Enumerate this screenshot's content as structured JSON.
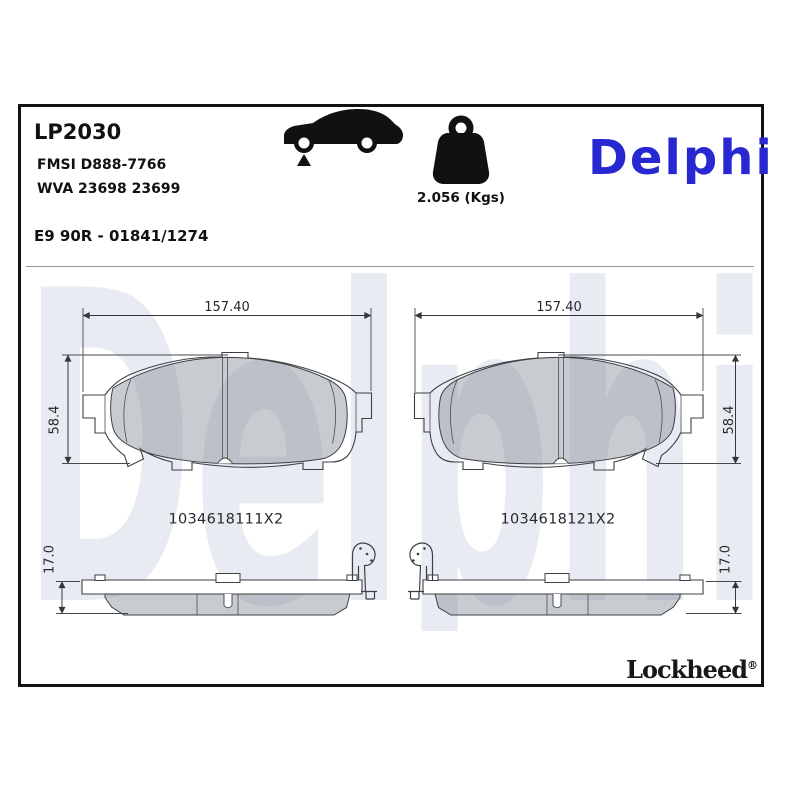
{
  "header": {
    "product_code": "LP2030",
    "fmsi": "FMSI D888-7766",
    "wva": "WVA 23698 23699",
    "homologation": "E9 90R - 01841/1274",
    "weight_label": "2.056 (Kgs)",
    "brand": "Delphi",
    "brand_color": "#2828d2"
  },
  "icons": {
    "car": "car-front-axle-icon",
    "weight": "kettlebell-weight-icon"
  },
  "drawings": {
    "front_left": {
      "width_dim": "157.40",
      "height_dim": "58.4",
      "reference": "1034618111X2"
    },
    "front_right": {
      "width_dim": "157.40",
      "height_dim": "58.4",
      "reference": "1034618121X2"
    },
    "side_left": {
      "thickness_dim": "17.0"
    },
    "side_right": {
      "thickness_dim": "17.0"
    },
    "line_color": "#3c4044",
    "pad_fill": "#868c96"
  },
  "watermark": {
    "text": "Delphi",
    "color": "#e9ebf3"
  },
  "footer": {
    "brand": "Lockheed",
    "registered_mark": "®"
  }
}
